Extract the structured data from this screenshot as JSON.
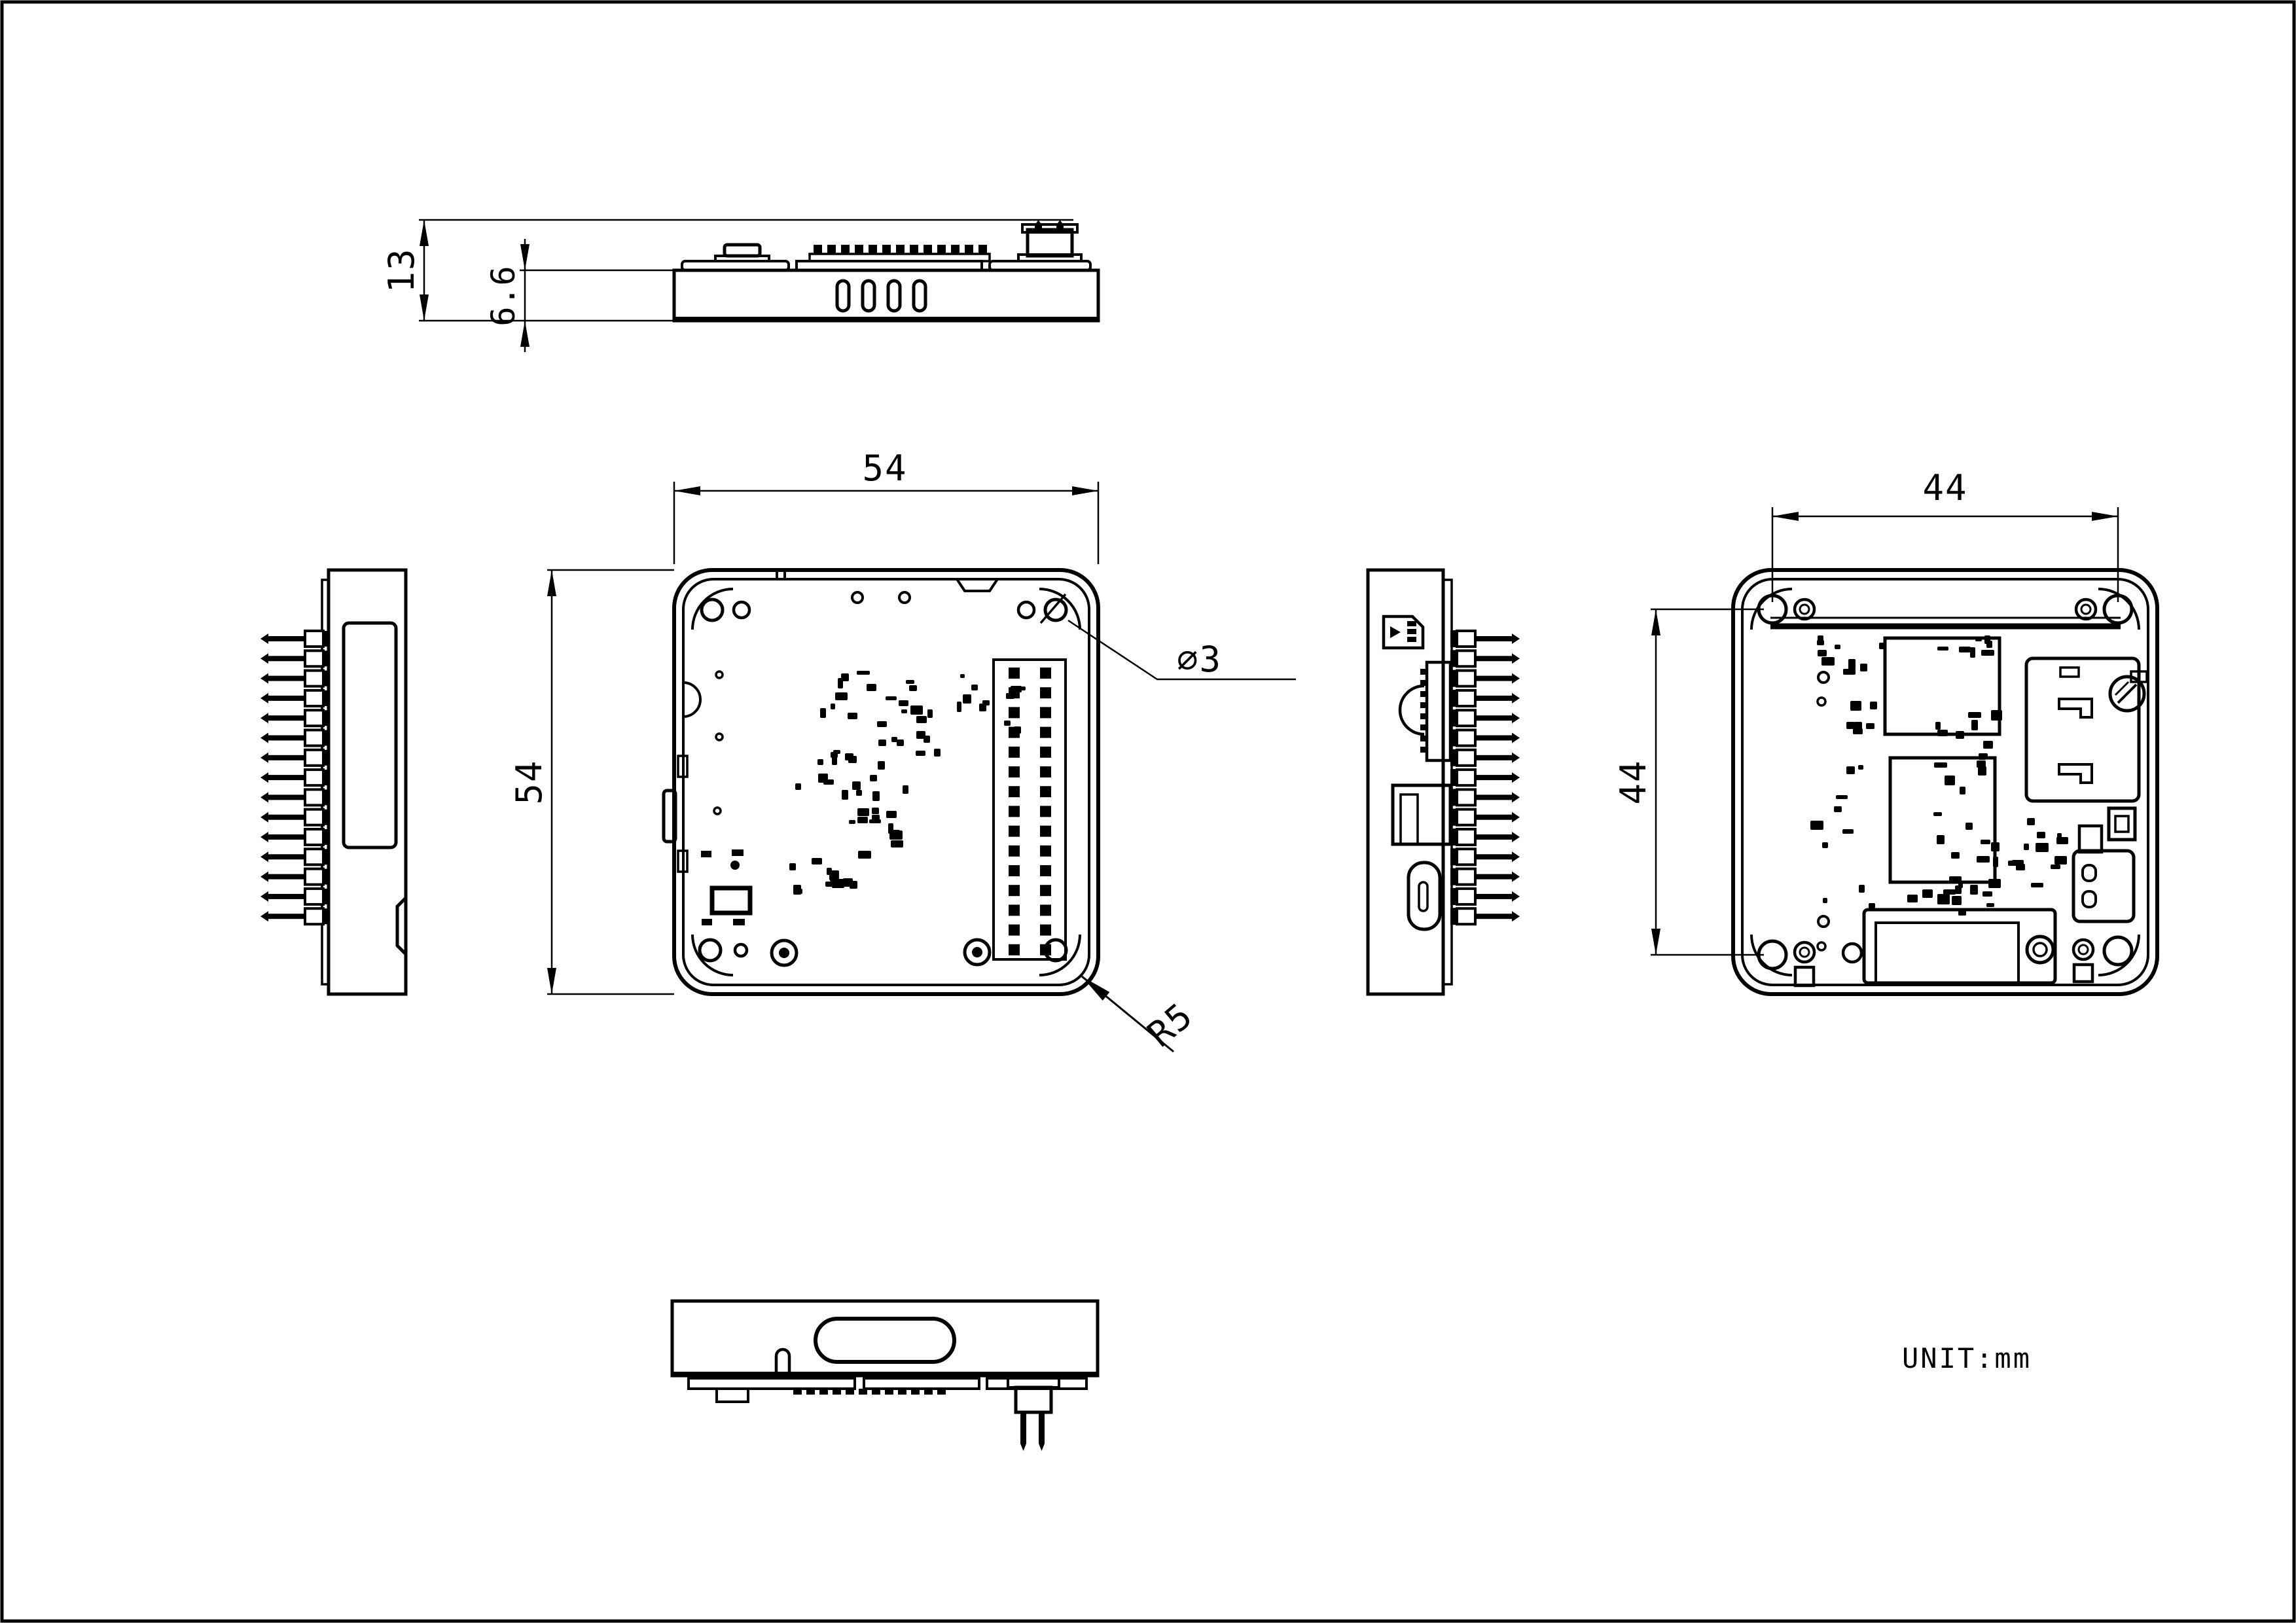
{
  "page": {
    "unit_note": "UNIT:mm"
  },
  "dimensions": {
    "top_total_height": "13",
    "top_case_height": "6.6",
    "front_width": "54",
    "front_height": "54",
    "hole_spacing_horizontal": "44",
    "hole_spacing_vertical": "44",
    "hole_diameter": "∅3",
    "corner_radius": "R5"
  }
}
